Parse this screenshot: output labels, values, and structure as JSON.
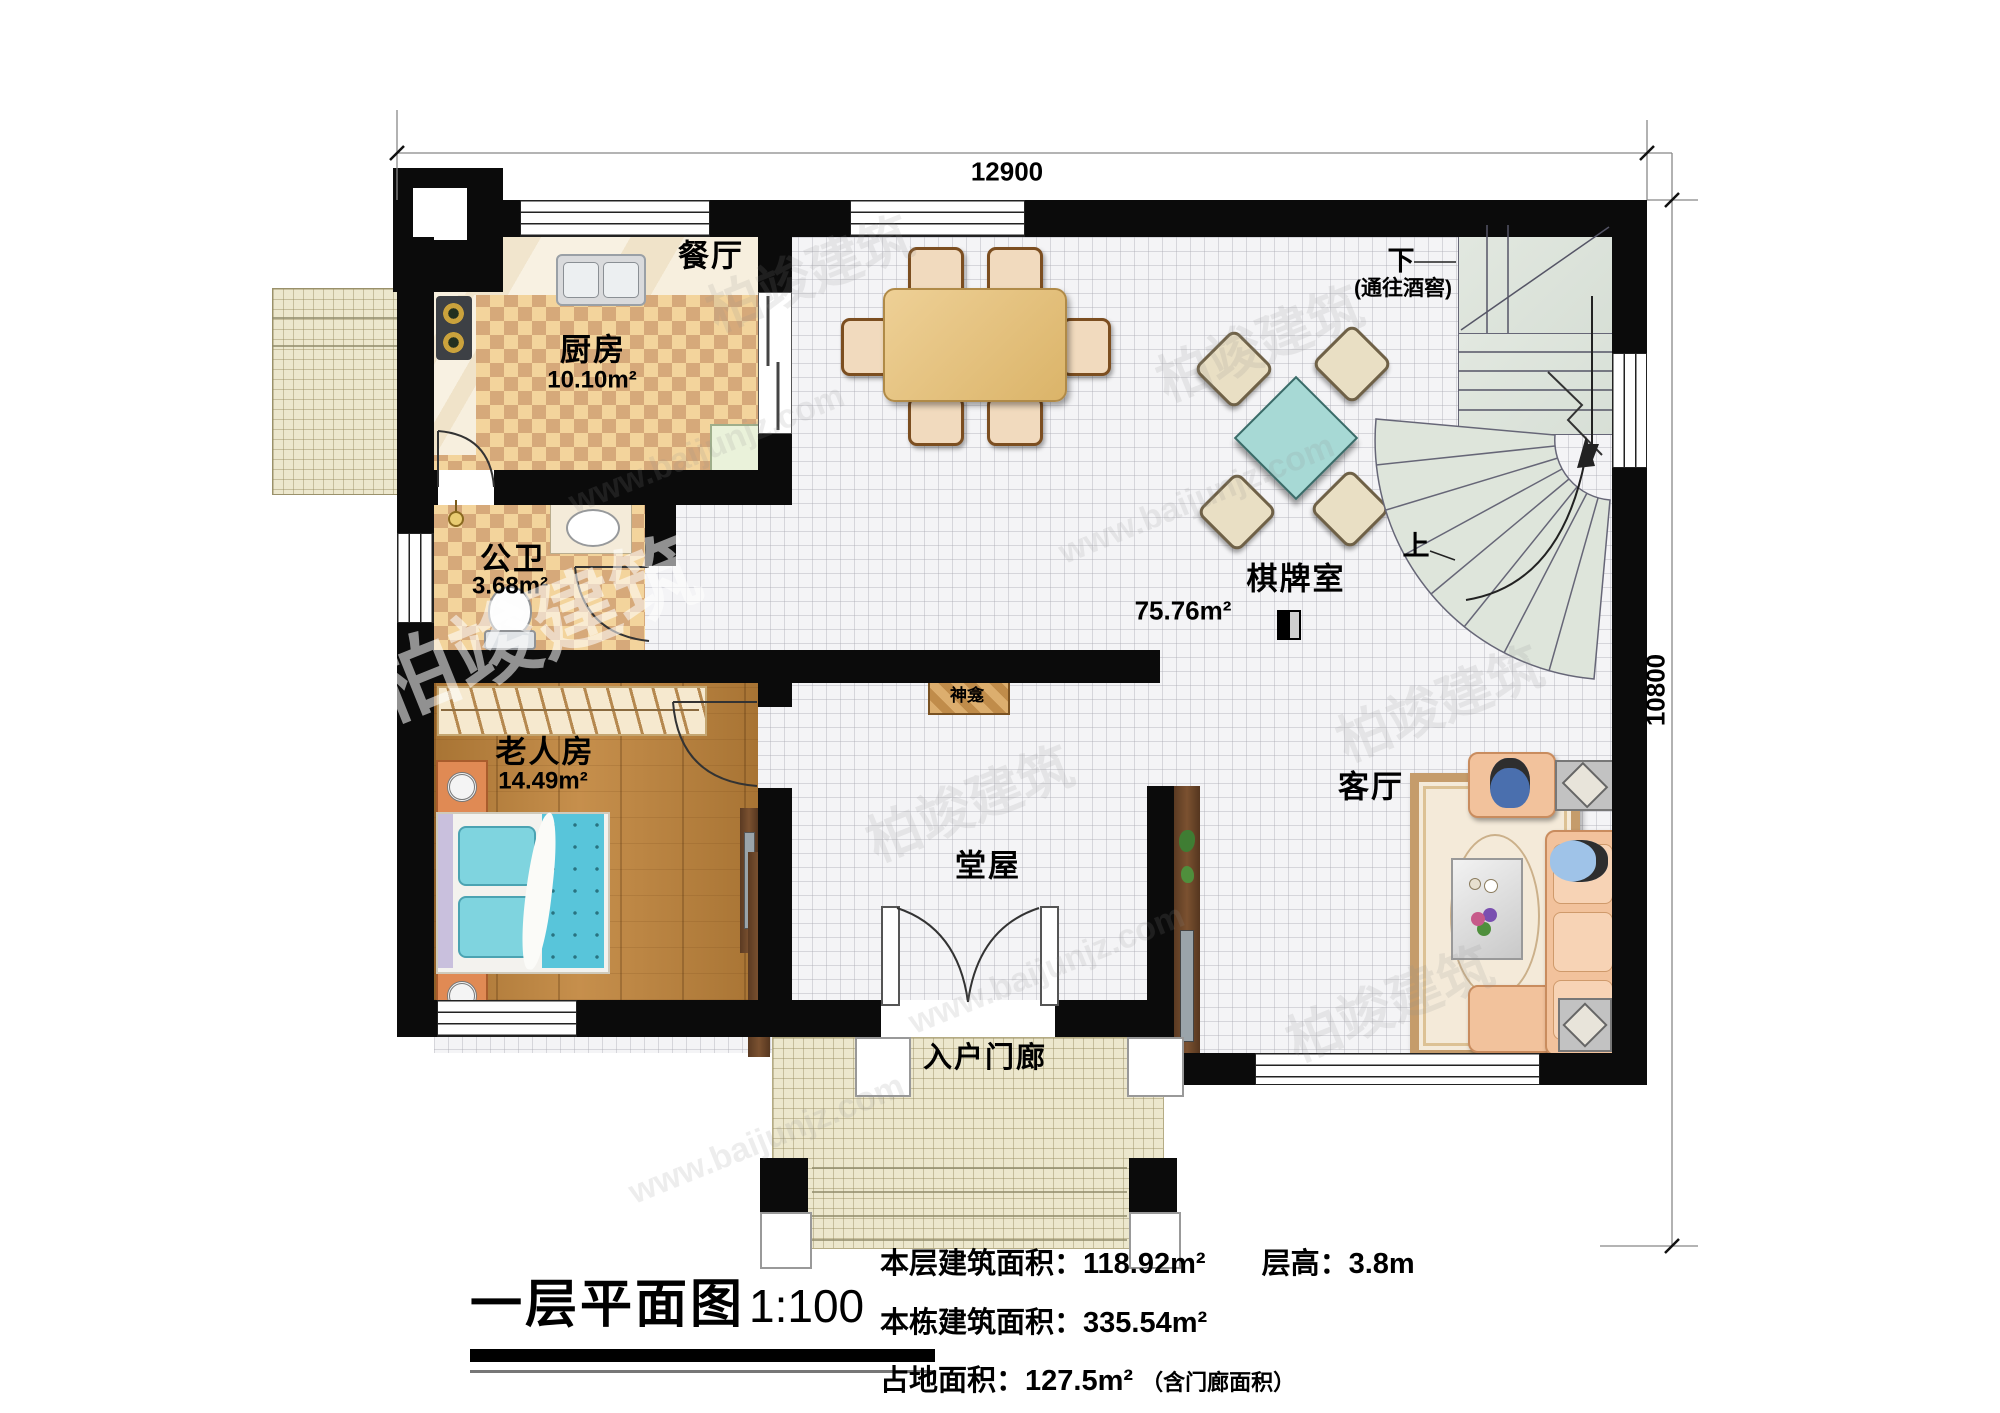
{
  "watermark": {
    "name": "柏竣建筑",
    "url": "www.baijunjz.com"
  },
  "dimensions": {
    "width": "12900",
    "height": "10800"
  },
  "rooms": {
    "dining": {
      "name": "餐厅"
    },
    "kitchen": {
      "name": "厨房",
      "area": "10.10m²"
    },
    "bathroom": {
      "name": "公卫",
      "area": "3.68m²"
    },
    "elder_room": {
      "name": "老人房",
      "area": "14.49m²"
    },
    "chess_room": {
      "name": "棋牌室"
    },
    "hall": {
      "name": "堂屋"
    },
    "living_room": {
      "name": "客厅"
    },
    "porch": {
      "name": "入户门廊"
    },
    "shrine": {
      "name": "神龛"
    },
    "open_area": {
      "area": "75.76m²"
    }
  },
  "stairs": {
    "down": "下",
    "down_note": "(通往酒窖)",
    "up": "上"
  },
  "title": {
    "name": "一层平面图",
    "scale": "1:100"
  },
  "stats": {
    "floor_area_label": "本层建筑面积：",
    "floor_area_value": "118.92m²",
    "story_height_label": "层高：",
    "story_height_value": "3.8m",
    "total_area_label": "本栋建筑面积：",
    "total_area_value": "335.54m²",
    "footprint_label": "占地面积：",
    "footprint_value": "127.5m²",
    "footprint_note": "（含门廊面积）"
  }
}
